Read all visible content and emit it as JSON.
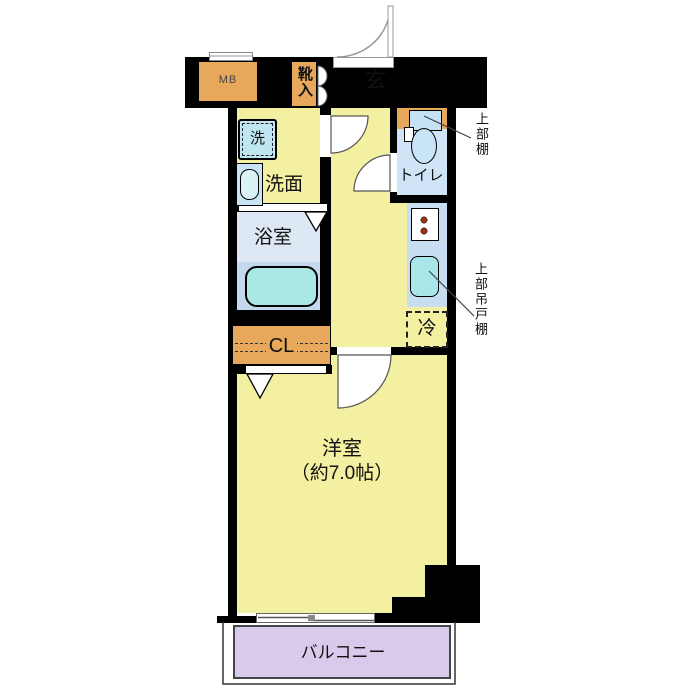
{
  "plan": {
    "rooms": {
      "entrance": "玄",
      "shoe_cabinet": "靴入",
      "meter_box": "MB",
      "washer": "洗",
      "washroom": "洗面",
      "bathroom": "浴室",
      "toilet": "トイレ",
      "closet": "CL",
      "refrigerator": "冷",
      "western_room": "洋室",
      "western_room_size": "（約7.0帖）",
      "balcony": "バルコニー"
    },
    "annotations": {
      "upper_shelf": "上部棚",
      "upper_hanging_cabinet": "上部吊戸棚"
    },
    "colors": {
      "wall": "#000000",
      "floor_yellow": "#F4F0A2",
      "entrance_gray": "#DBDBDB",
      "accent_orange": "#E8A85C",
      "toilet_floor_blue": "#CFE5F7",
      "counter_blue": "#C6DDF2",
      "bath_upper_blue": "#DEE7F4",
      "bath_lower_blue": "#C5D9EE",
      "fixture_cyan": "#A9E8E4",
      "washer_blue": "#BFE7F2",
      "balcony_lavender": "#D9CAEB"
    }
  }
}
